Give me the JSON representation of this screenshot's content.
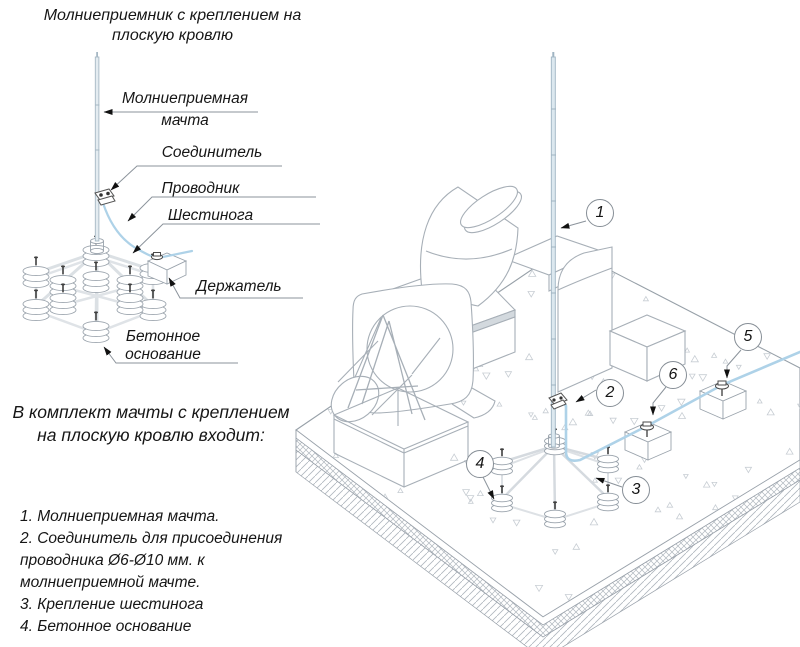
{
  "title": {
    "line1": "Молниеприемник с креплением на",
    "line2": "плоскую кровлю"
  },
  "detail_labels": {
    "mast_line1": "Молниеприемная",
    "mast_line2": "мачта",
    "connector": "Соединитель",
    "conductor": "Проводник",
    "hexapod": "Шестинога",
    "holder": "Держатель",
    "base_line1": "Бетонное",
    "base_line2": "основание"
  },
  "kit": {
    "heading_line1": "В комплект мачты с креплением",
    "heading_line2": "на плоскую кровлю входит:",
    "items": [
      "1. Молниеприемная мачта.",
      "2. Соединитель для присоединения проводника Ø6-Ø10 мм. к молниеприемной мачте.",
      "3. Крепление шестинога",
      "4. Бетонное основание"
    ]
  },
  "callouts": [
    "1",
    "2",
    "3",
    "4",
    "5",
    "6"
  ],
  "colors": {
    "conductor": "#aed2e8",
    "machline": "#a7afb7",
    "leader": "#8b939b",
    "ink": "#161616"
  }
}
